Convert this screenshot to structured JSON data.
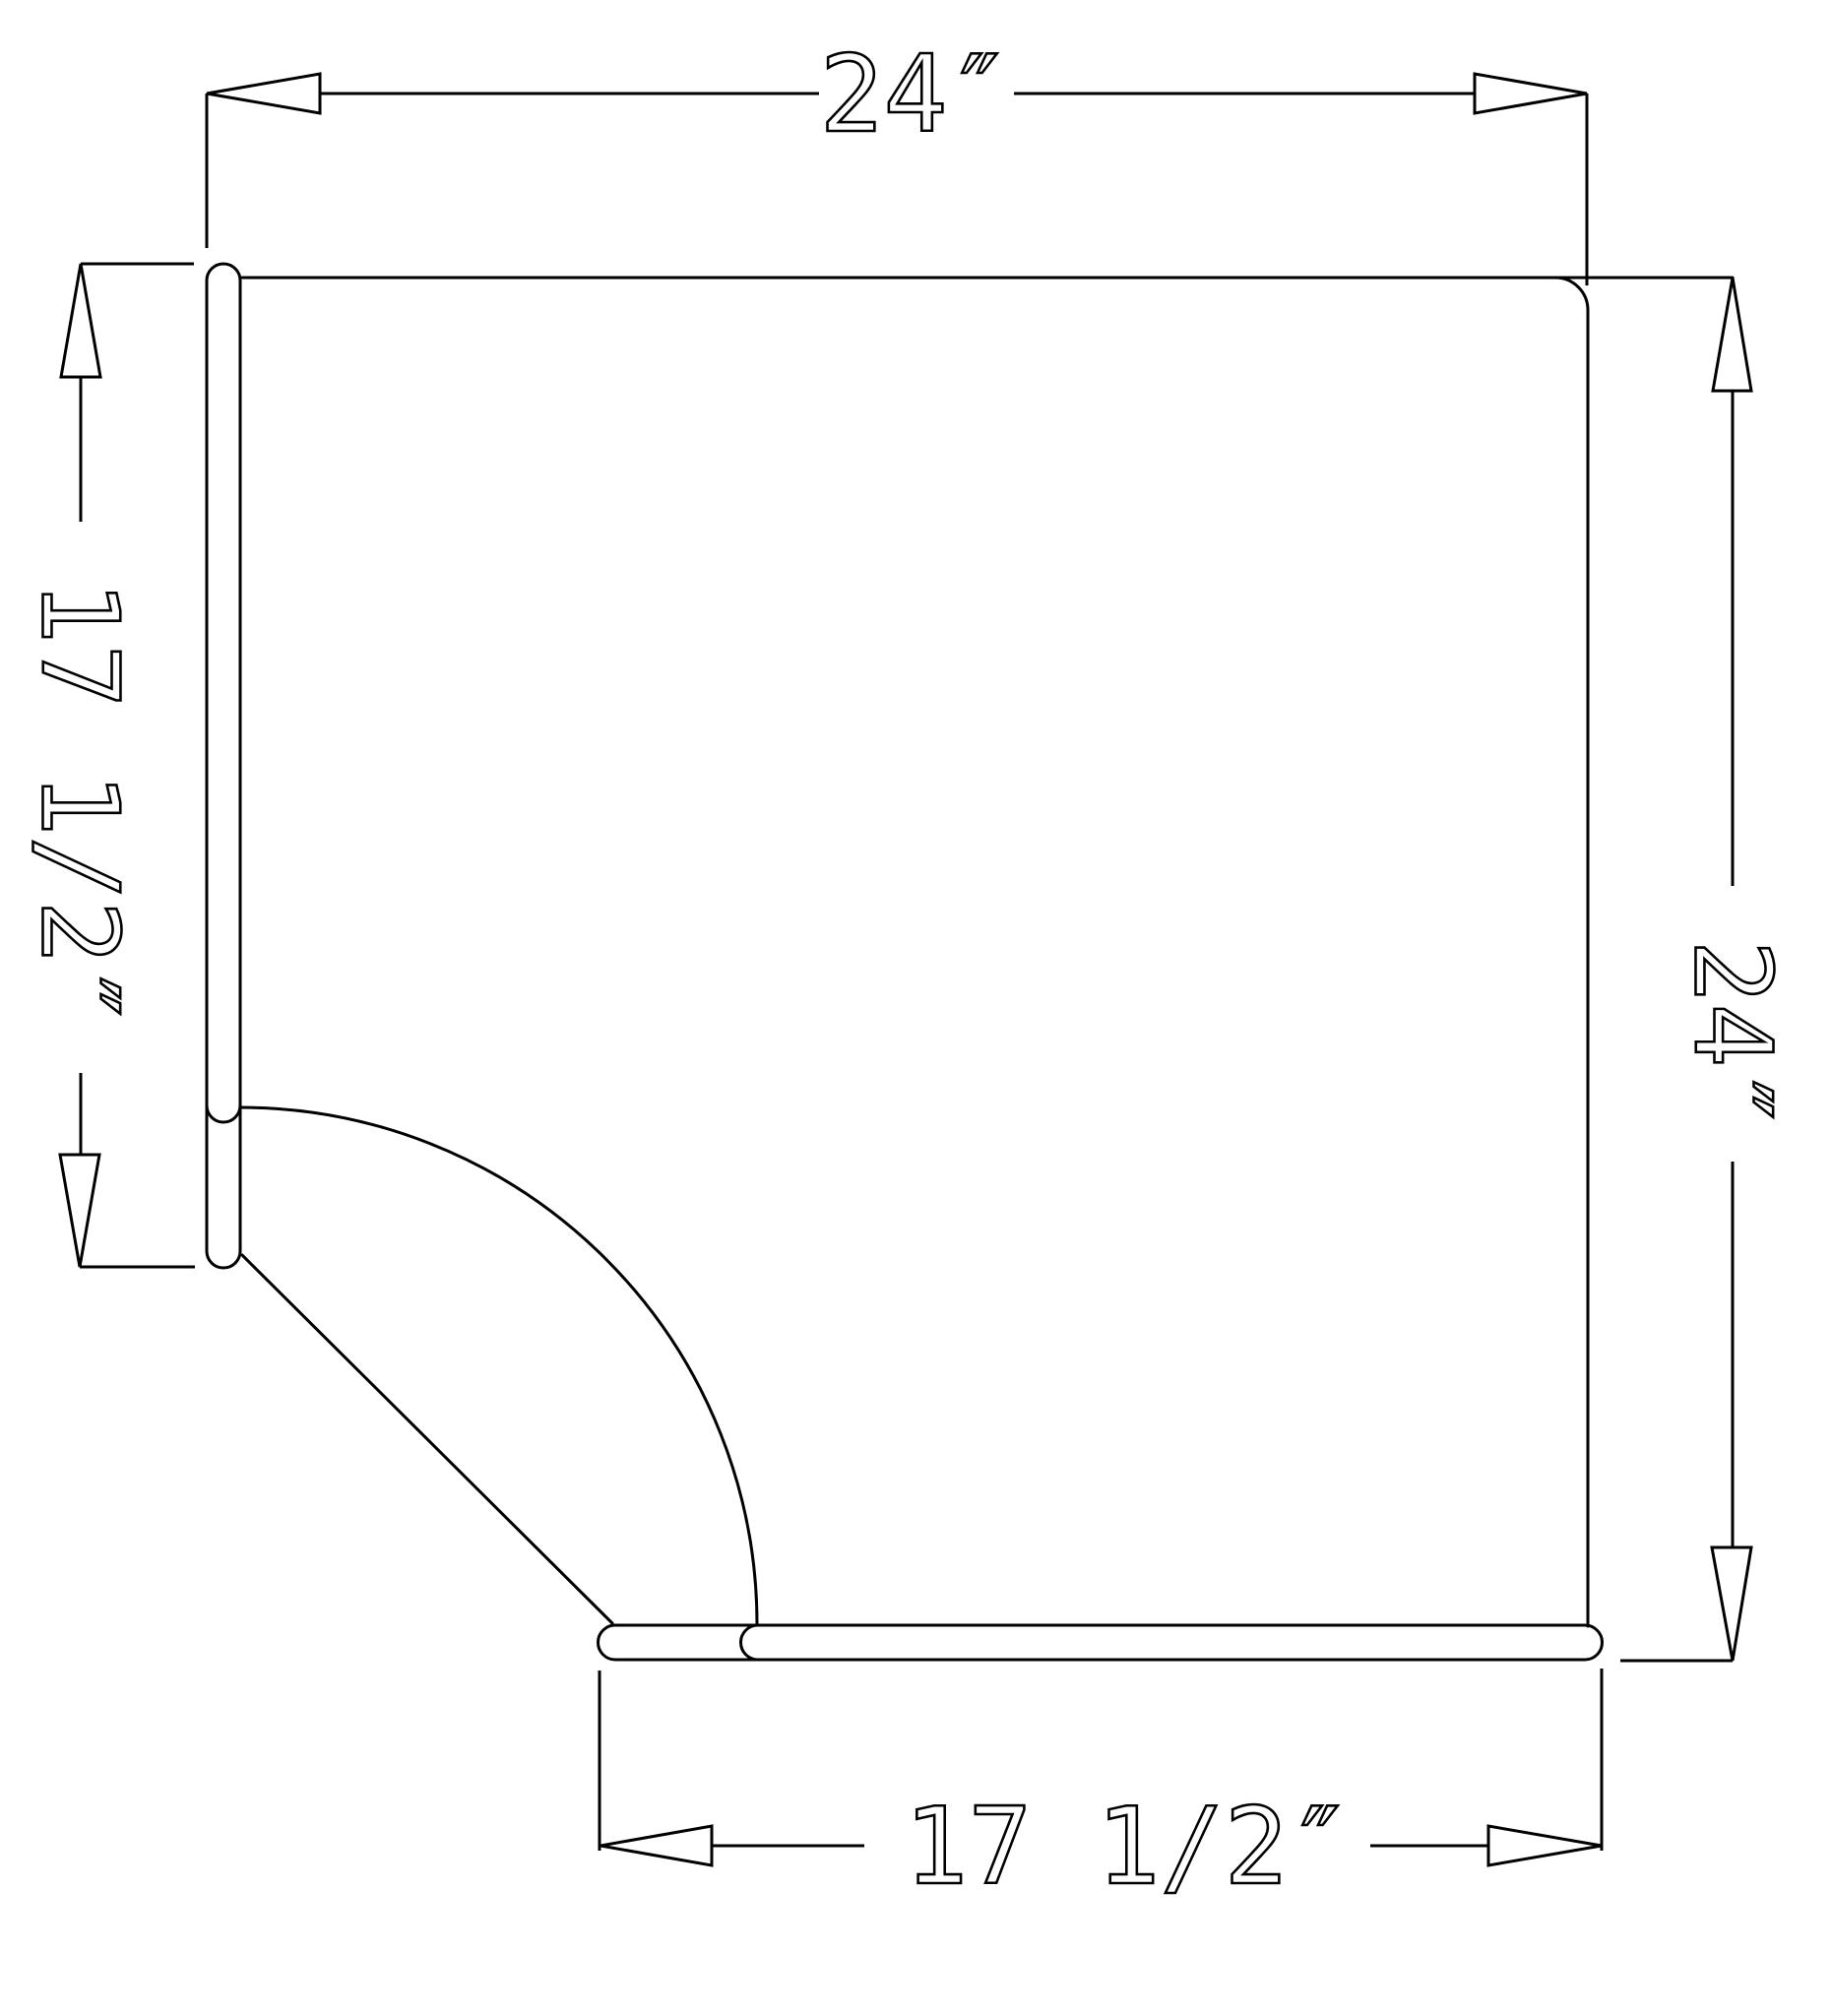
{
  "drawing": {
    "background_color": "#ffffff",
    "line_color": "#000000",
    "dimensions": {
      "top": {
        "label": "24″"
      },
      "right": {
        "label": "24″"
      },
      "left": {
        "label": "17 1/2″"
      },
      "bottom": {
        "label": "17 1/2″"
      }
    }
  }
}
